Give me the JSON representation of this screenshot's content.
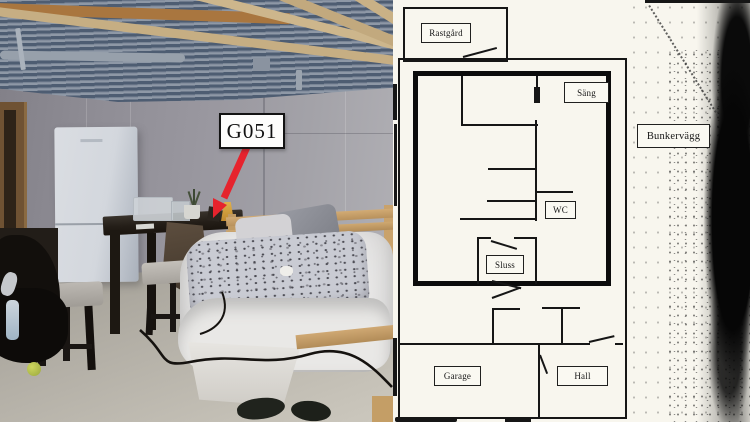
{
  "page": {
    "kind": "crime-scene photo with bunker floor plan",
    "photo": {
      "evidence_label": "G051",
      "colors": {
        "arrow_red": "#e6232d",
        "wall_grey": "#99979f",
        "floor_grey": "#b4b0a7",
        "ceiling_rib_dark": "#4e5d72",
        "joist_wood": "#c2a97e",
        "bed_frame_pine": "#c3a069",
        "desk_dark": "#241e18"
      },
      "objects": [
        "corrugated-metal-ceiling",
        "wood-joists",
        "door-frame",
        "refrigerator",
        "desk",
        "storage-box",
        "plant",
        "lamp",
        "towel",
        "paper-bag",
        "chair",
        "chair",
        "clothes-pile",
        "water-bottle",
        "tennis-ball",
        "bed",
        "patterned-duvet",
        "grey-pillow",
        "white-pillow",
        "hanging-sheet",
        "power-cable",
        "shoes"
      ]
    },
    "floorplan": {
      "paper": "#f8f6ee",
      "ink": "#161616",
      "labels": {
        "rastgard": "Rastgård",
        "sang": "Säng",
        "wc": "WC",
        "sluss": "Sluss",
        "garage": "Garage",
        "hall": "Hall",
        "bunkervagg": "Bunkervägg"
      }
    }
  }
}
